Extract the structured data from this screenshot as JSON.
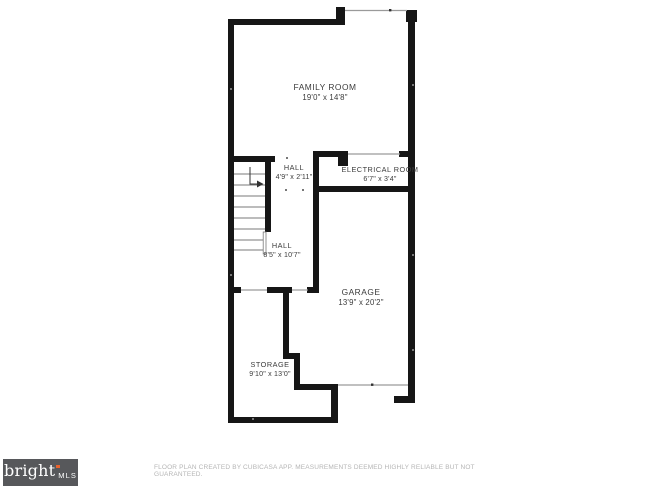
{
  "plan": {
    "rooms": [
      {
        "id": "family-room",
        "name": "FAMILY ROOM",
        "dims": "19'0\" x 14'8\"",
        "x": 325,
        "y": 83,
        "size": "lg"
      },
      {
        "id": "hall-upper",
        "name": "HALL",
        "dims": "4'9\" x 2'11\"",
        "x": 294,
        "y": 164,
        "size": "sm"
      },
      {
        "id": "electrical-room",
        "name": "ELECTRICAL ROOM",
        "dims": "6'7\" x 3'4\"",
        "x": 380,
        "y": 166,
        "size": "sm"
      },
      {
        "id": "hall-lower",
        "name": "HALL",
        "dims": "8'5\" x 10'7\"",
        "x": 282,
        "y": 242,
        "size": "sm"
      },
      {
        "id": "garage",
        "name": "GARAGE",
        "dims": "13'9\" x 20'2\"",
        "x": 361,
        "y": 288,
        "size": "lg"
      },
      {
        "id": "storage",
        "name": "STORAGE",
        "dims": "9'10\" x 13'0\"",
        "x": 270,
        "y": 361,
        "size": "sm"
      }
    ]
  },
  "footer": {
    "logo": {
      "brand": "bright",
      "suffix": "MLS",
      "background": "#57585b",
      "accent": "#e8622d",
      "text_color": "#ffffff"
    },
    "disclaimer": "FLOOR PLAN CREATED BY CUBICASA APP. MEASUREMENTS DEEMED HIGHLY RELIABLE BUT NOT GUARANTEED."
  },
  "colors": {
    "wall": "#161616",
    "thin_line": "#9a9a9a",
    "label_text": "#3b3b3b",
    "disclaimer_text": "#b5b5b5"
  }
}
